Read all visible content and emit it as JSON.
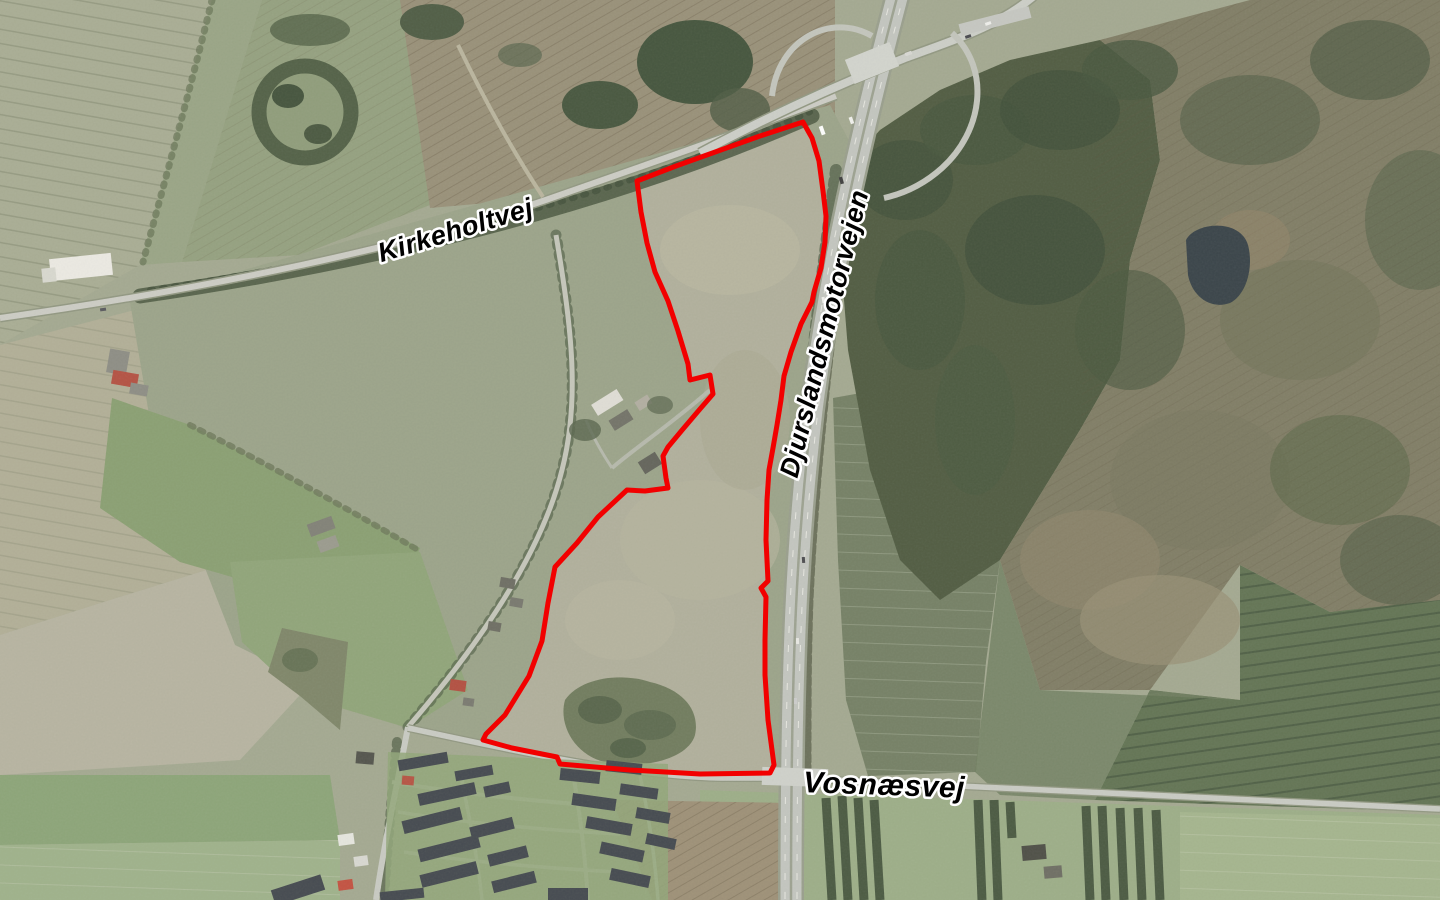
{
  "map": {
    "description": "Aerial orthophoto with land parcel annotation",
    "labels": [
      {
        "id": "kirkeholtvej",
        "text": "Kirkeholtvej",
        "x": 456,
        "y": 232,
        "rotation": -17,
        "font_size": 27,
        "transform": "translate(456,232) rotate(-17)"
      },
      {
        "id": "djurslandsmotorvejen",
        "text": "Djurslandsmotorvejen",
        "x": 826,
        "y": 334,
        "rotation": -76,
        "font_size": 27,
        "transform": "translate(826,334) rotate(-76)"
      },
      {
        "id": "vosnaesvej",
        "text": "Vosnæsvej",
        "x": 884,
        "y": 787,
        "rotation": 2,
        "font_size": 30,
        "transform": "translate(884,787) rotate(2)"
      }
    ],
    "parcel_boundary": {
      "color": "#f20000",
      "stroke_width": 5,
      "points": "803,122 760,136 718,151 676,166 637,181 641,212 647,243 655,272 668,301 678,331 688,364 690,380 710,375 713,394 700,409 683,429 668,447 663,456 666,478 668,488 645,491 627,490 598,517 577,543 555,567 548,603 542,641 529,676 505,715 486,734 483,740 512,748 557,757 560,764 630,770 700,774 770,773 774,765 768,720 765,675 765,640 766,597 761,588 768,581 766,540 767,500 769,470 773,448 777,425 781,400 784,376 791,352 801,324 812,302 814,292 821,268 825,242 826,216 823,191 819,161 812,138"
    }
  },
  "colors": {
    "parcel_outline": "#f20000",
    "label_text": "#000000",
    "label_halo": "#ffffff",
    "field_light": "#a7ab92",
    "field_green": "#879e6f",
    "pasture": "#99a287",
    "parcel_field": "#afae9a",
    "forest_dark": "#4c573d",
    "forest_scrub": "#7d7a62",
    "road": "#c9cbc3",
    "motorway": "#c2c5bf",
    "pond": "#333e44",
    "roof_dark": "#3f444b"
  }
}
